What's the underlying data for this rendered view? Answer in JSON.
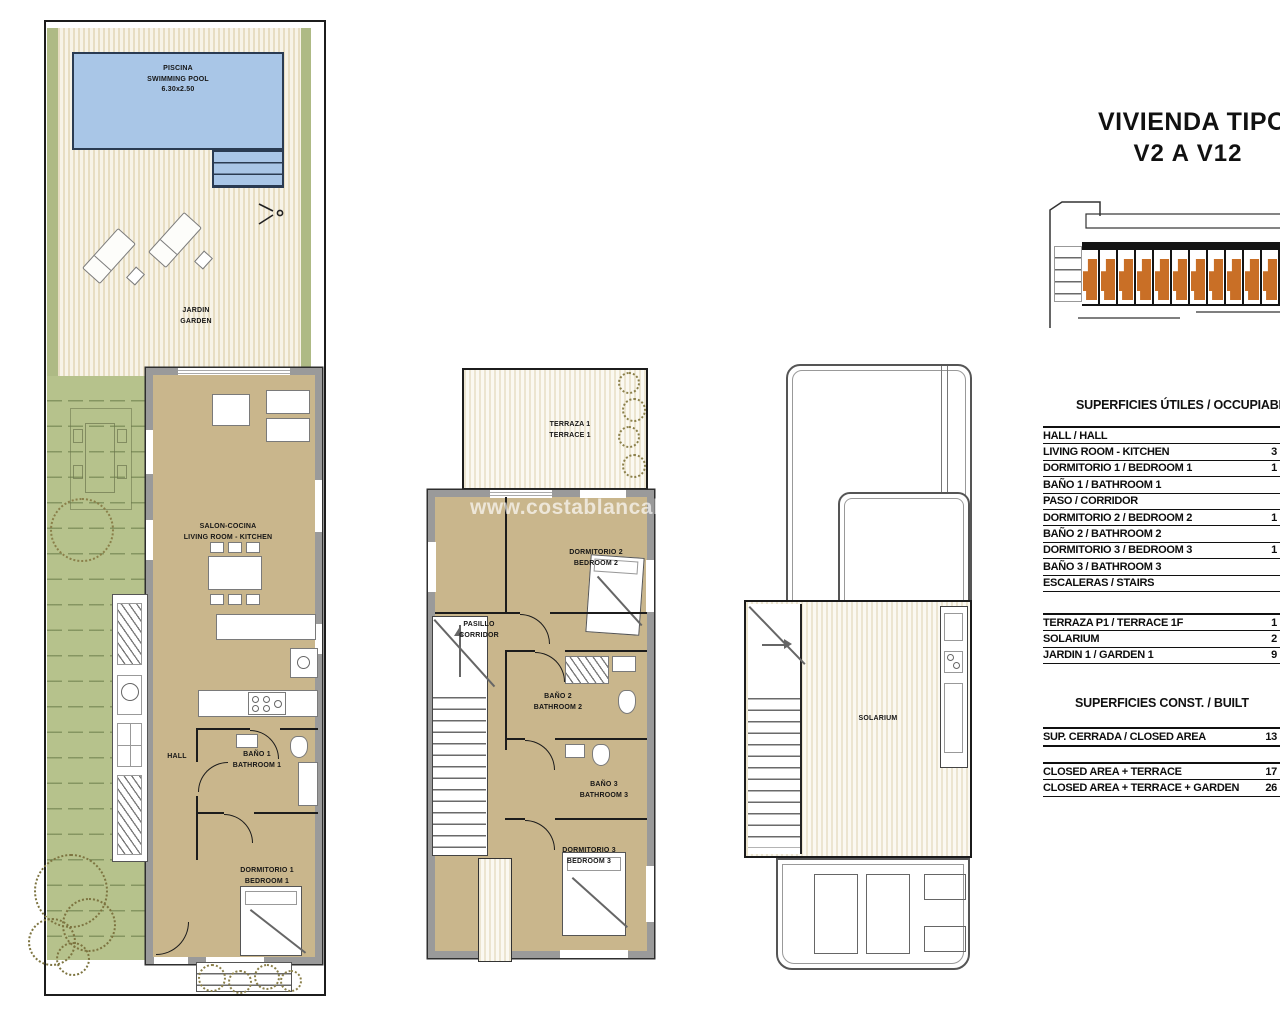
{
  "title": {
    "line1": "VIVIENDA TIPO",
    "line2": "V2 A V12"
  },
  "watermark": "www.costablancaho",
  "key_plan": {
    "units": 11,
    "unit_color": "#c96f26"
  },
  "colors": {
    "pool": "#a9c6e7",
    "deck_stripe": "#e7ddc2",
    "floor_tan": "#c9b68c",
    "wall_gray": "#9a9a9a",
    "garden_green": "#b6c28c",
    "unit_orange": "#c96f26"
  },
  "ground_floor": {
    "pool_label": "PISCINA\nSWIMMING POOL\n6.30x2.50",
    "garden_label": "JARDIN\nGARDEN",
    "living_label": "SALON-COCINA\nLIVING ROOM - KITCHEN",
    "hall_label": "HALL",
    "bath1_label": "BAÑO 1\nBATHROOM 1",
    "bed1_label": "DORMITORIO 1\nBEDROOM 1"
  },
  "first_floor": {
    "terrace_label": "TERRAZA 1\nTERRACE 1",
    "bed2_label": "DORMITORIO 2\nBEDROOM 2",
    "corridor_label": "PASILLO\nCORRIDOR",
    "bath2_label": "BAÑO 2\nBATHROOM 2",
    "bath3_label": "BAÑO 3\nBATHROOM 3",
    "bed3_label": "DORMITORIO 3\nBEDROOM 3"
  },
  "solarium_floor": {
    "label": "SOLARIUM"
  },
  "areas_table": {
    "useful_header": "SUPERFICIES ÚTILES / OCCUPIABLE",
    "useful_rows": [
      {
        "label": "HALL / HALL",
        "value": ""
      },
      {
        "label": "LIVING ROOM - KITCHEN",
        "value": "3"
      },
      {
        "label": "DORMITORIO 1 /  BEDROOM 1",
        "value": "1"
      },
      {
        "label": "BAÑO 1 / BATHROOM 1",
        "value": ""
      },
      {
        "label": "PASO / CORRIDOR",
        "value": ""
      },
      {
        "label": "DORMITORIO 2 / BEDROOM 2",
        "value": "1"
      },
      {
        "label": "BAÑO 2 / BATHROOM 2",
        "value": ""
      },
      {
        "label": "DORMITORIO 3 / BEDROOM 3",
        "value": "1"
      },
      {
        "label": "BAÑO 3 / BATHROOM 3",
        "value": ""
      },
      {
        "label": "ESCALERAS / STAIRS",
        "value": ""
      }
    ],
    "outdoor_rows": [
      {
        "label": "TERRAZA P1 / TERRACE 1F",
        "value": "1"
      },
      {
        "label": "SOLARIUM",
        "value": "2"
      },
      {
        "label": "JARDIN 1 / GARDEN 1",
        "value": "9"
      }
    ],
    "built_header": "SUPERFICIES  CONST. / BUILT",
    "built_rows": [
      {
        "label": "SUP. CERRADA / CLOSED AREA",
        "value": "13"
      }
    ],
    "total_rows": [
      {
        "label": "CLOSED AREA + TERRACE",
        "value": "17"
      },
      {
        "label": "CLOSED AREA + TERRACE + GARDEN",
        "value": "26"
      }
    ]
  }
}
